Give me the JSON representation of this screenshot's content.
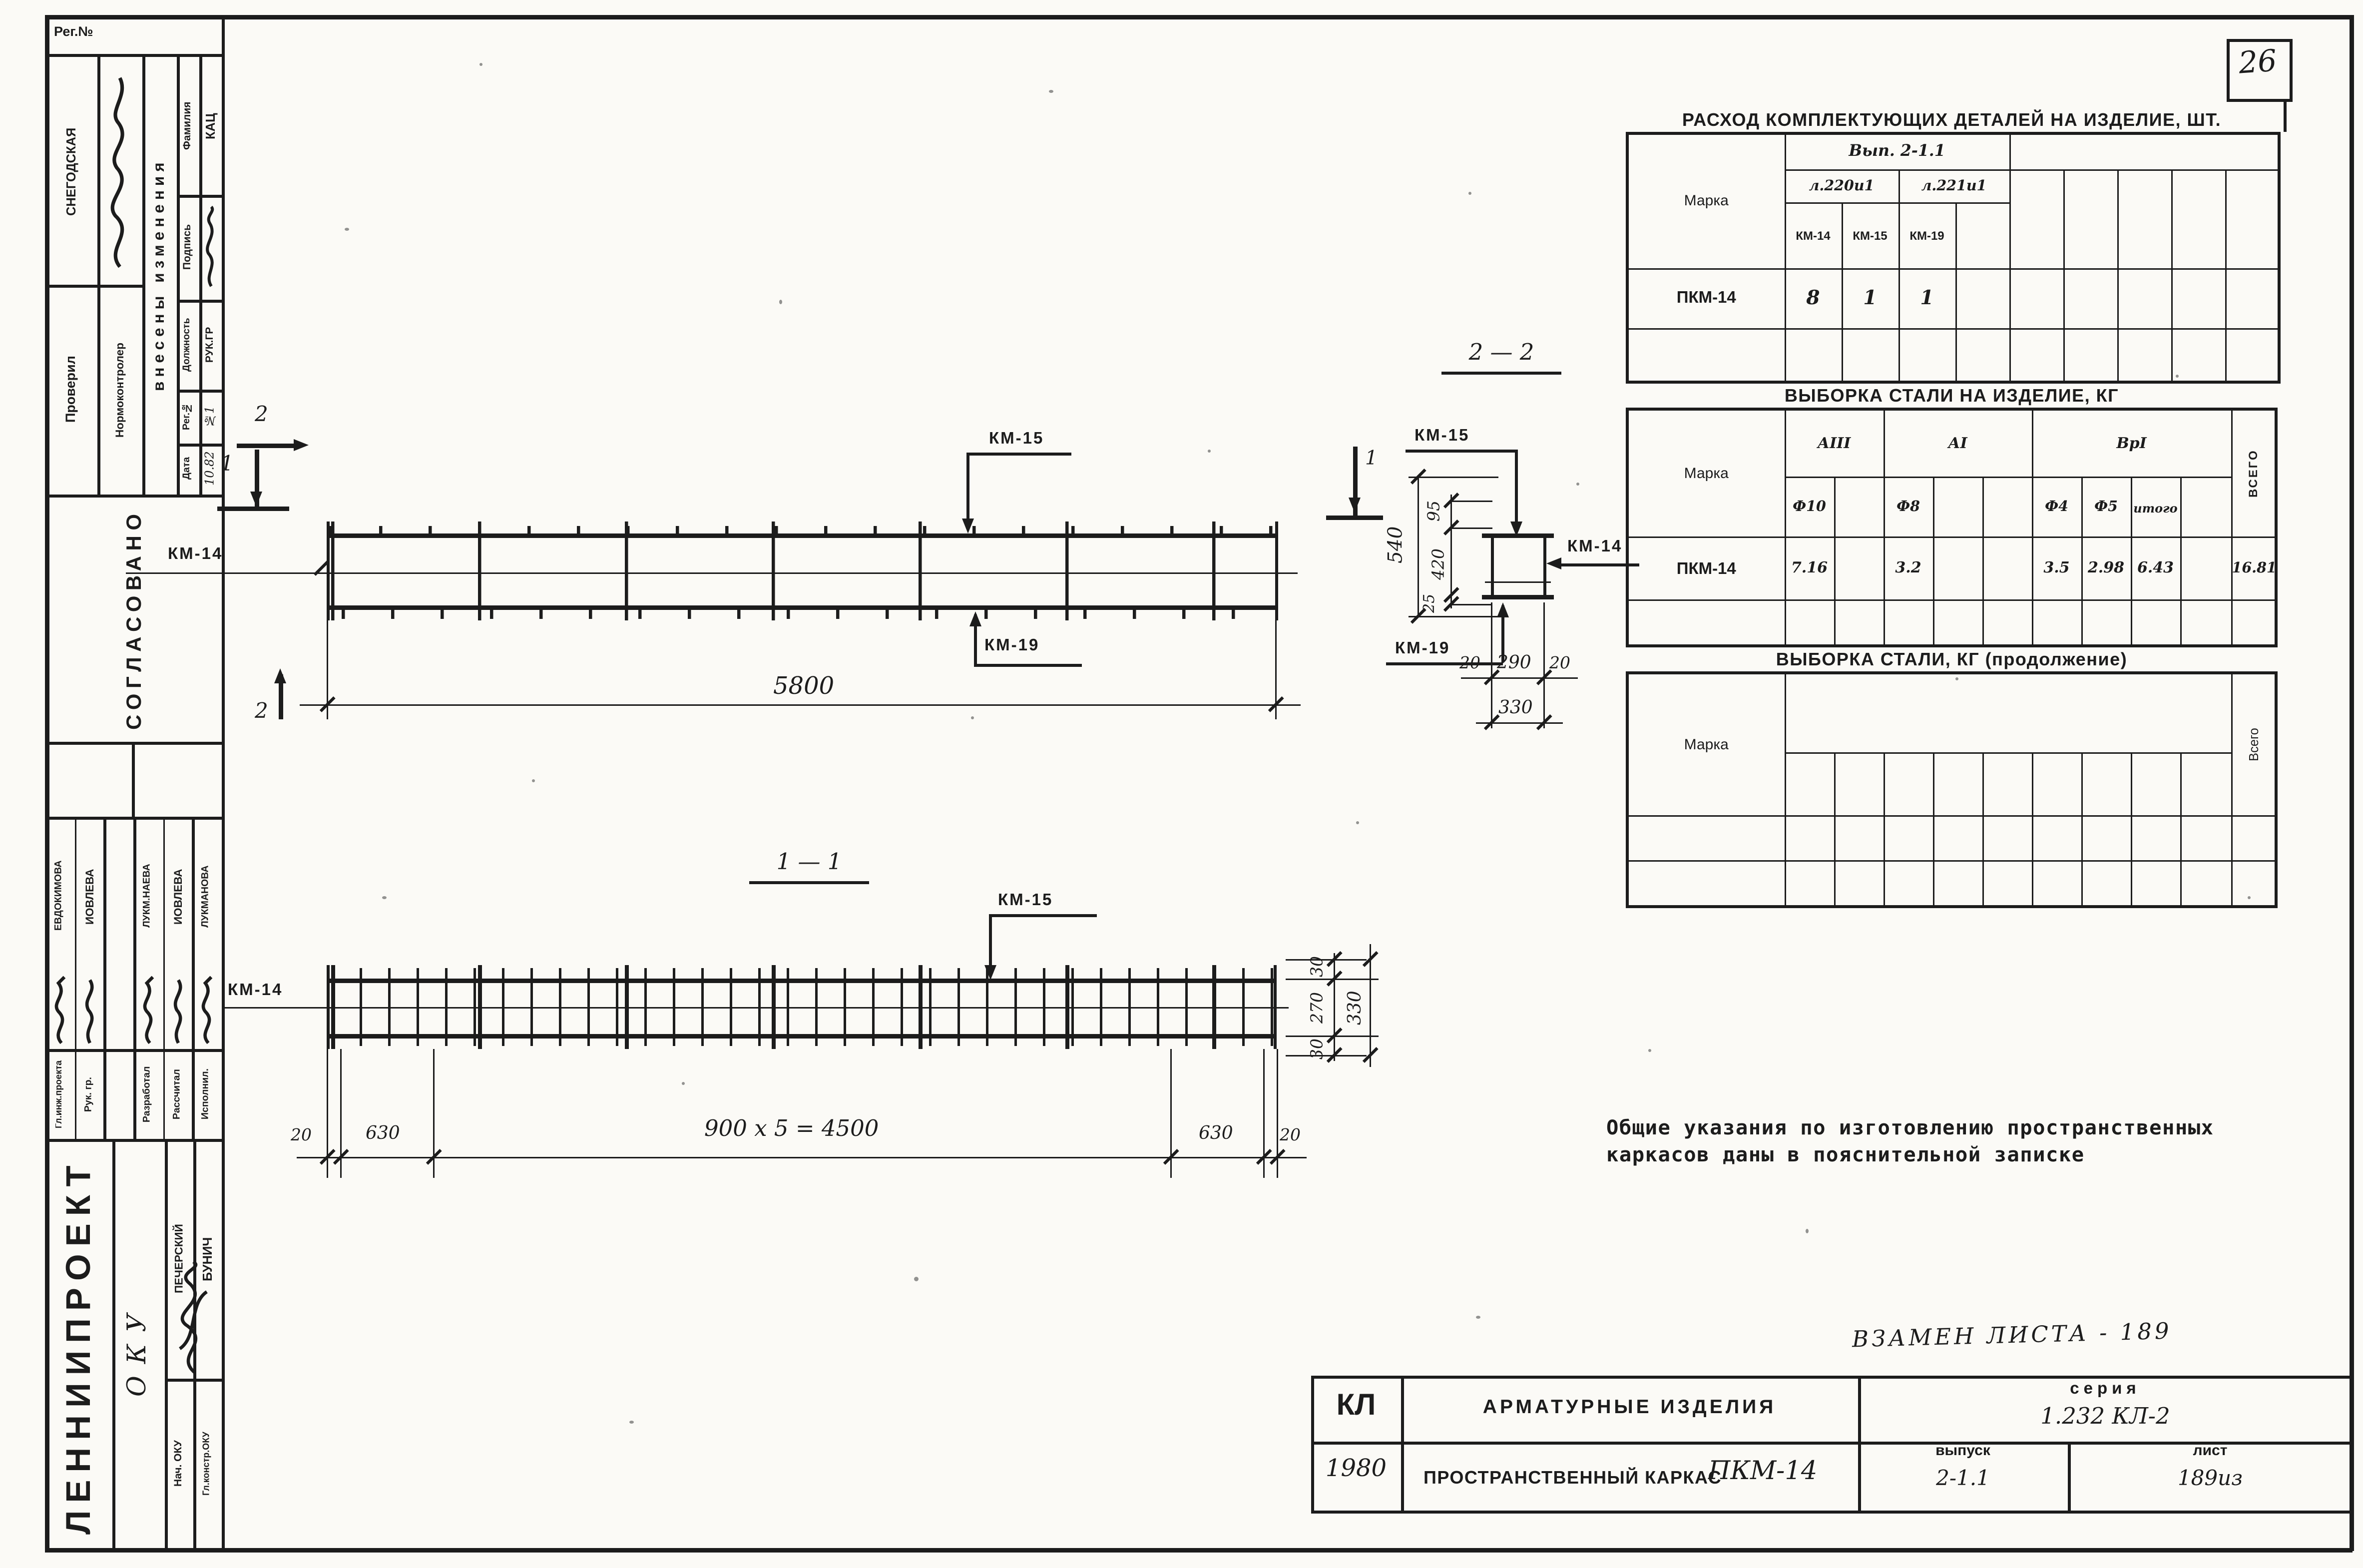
{
  "colors": {
    "ink": "#1c1c1c",
    "paper": "#fbfaf6"
  },
  "corner": {
    "sheet_number": "26"
  },
  "left_stamp": {
    "reg_label": "Рег.№",
    "checked_name": "СНЕГОДСКАЯ",
    "checked_label": "Проверил",
    "normcontrol_label": "Нормоконтролер",
    "changes_banner": "внесены изменения",
    "fam_label": "Фамилия",
    "fam_value": "КАЦ",
    "sign_label": "Подпись",
    "pos_label": "Должность",
    "pos_value": "РУК.ГР",
    "reg2_label": "Рег.№",
    "reg2_value": "№1",
    "date_label": "Дата",
    "date_value": "10.82",
    "agreed": "СОГЛАСОВАНО",
    "names": [
      "ЕВДОКИМОВА",
      "ИОВЛЕВА",
      "ЛУКМ.НАЕВА",
      "ИОВЛЕВА",
      "ЛУКМАНОВА"
    ],
    "roles": [
      "Гл.инж.проекта",
      "Рук. гр.",
      "Разработал",
      "Рассчитал",
      "Исполнил."
    ],
    "org": "ЛЕННИИПРОЕКТ",
    "org_mark": "ОКУ",
    "staff": [
      {
        "role": "Нач. ОКУ",
        "name": "ПЕЧЕРСКИЙ"
      },
      {
        "role": "Гл.констр.ОКУ",
        "name": "БУНИЧ"
      }
    ]
  },
  "parts_table": {
    "title": "РАСХОД КОМПЛЕКТУЮЩИХ ДЕТАЛЕЙ НА ИЗДЕЛИЕ,  ШТ.",
    "marka_label": "Марка",
    "issue_header": "Вып. 2-1.1",
    "sheet_headers": [
      "л.220и1",
      "л.221и1"
    ],
    "col_headers": [
      "КМ-14",
      "КМ-15",
      "КМ-19"
    ],
    "row": {
      "marka": "ПКМ-14",
      "values": [
        "8",
        "1",
        "1"
      ]
    }
  },
  "steel_table": {
    "title": "ВЫБОРКА СТАЛИ НА ИЗДЕЛИЕ,  КГ",
    "marka_label": "Марка",
    "class_headers": [
      "АIII",
      "АI",
      "ВрI"
    ],
    "dia_headers": [
      "Ф10",
      "Ф8",
      "Ф4",
      "Ф5",
      "итого"
    ],
    "total_label": "ВСЕГО",
    "row": {
      "marka": "ПКМ-14",
      "f10": "7.16",
      "f8": "3.2",
      "f4": "3.5",
      "f5": "2.98",
      "itogo": "6.43",
      "total": "16.81"
    }
  },
  "steel_table_cont": {
    "title": "ВЫБОРКА СТАЛИ,  КГ (продолжение)",
    "marka_label": "Марка",
    "total_label": "Всего"
  },
  "note": {
    "line1": "Общие указания по изготовлению пространственных",
    "line2": "каркасов даны в пояснительной записке"
  },
  "replaces_note": "ВЗАМЕН  ЛИСТА - 189",
  "title_block": {
    "org_code": "КЛ",
    "year": "1980",
    "doc_title": "АРМАТУРНЫЕ  ИЗДЕЛИЯ",
    "product_title": "ПРОСТРАНСТВЕННЫЙ КАРКАС",
    "product_code": "ПКМ-14",
    "series_label": "серия",
    "series_value": "1.232 КЛ-2",
    "issue_label": "выпуск",
    "issue_value": "2-1.1",
    "sheet_label": "лист",
    "sheet_value": "189из"
  },
  "plan_view": {
    "mark2": "2",
    "mark1": "1",
    "label_km14": "КМ-14",
    "label_km15": "КМ-15",
    "label_km19": "КМ-19",
    "dim_total": "5800"
  },
  "section_view": {
    "title": "2 — 2",
    "label_km15": "КМ-15",
    "label_km14": "КМ-14",
    "label_km19": "КМ-19",
    "dim_total_h": "540",
    "dim_top": "95",
    "dim_mid": "420",
    "dim_bot": "25",
    "dim_left": "20",
    "dim_center": "290",
    "dim_right": "20",
    "dim_width": "330"
  },
  "elevation_view": {
    "title": "1 — 1",
    "label_km14": "КМ-14",
    "label_km15": "КМ-15",
    "dim_left_end": "20",
    "dim_left": "630",
    "dim_middle": "900 x 5 = 4500",
    "dim_right": "630",
    "dim_right_end": "20",
    "dim_v_top": "30",
    "dim_v_mid": "270",
    "dim_v_bot": "30",
    "dim_v_total": "330"
  }
}
